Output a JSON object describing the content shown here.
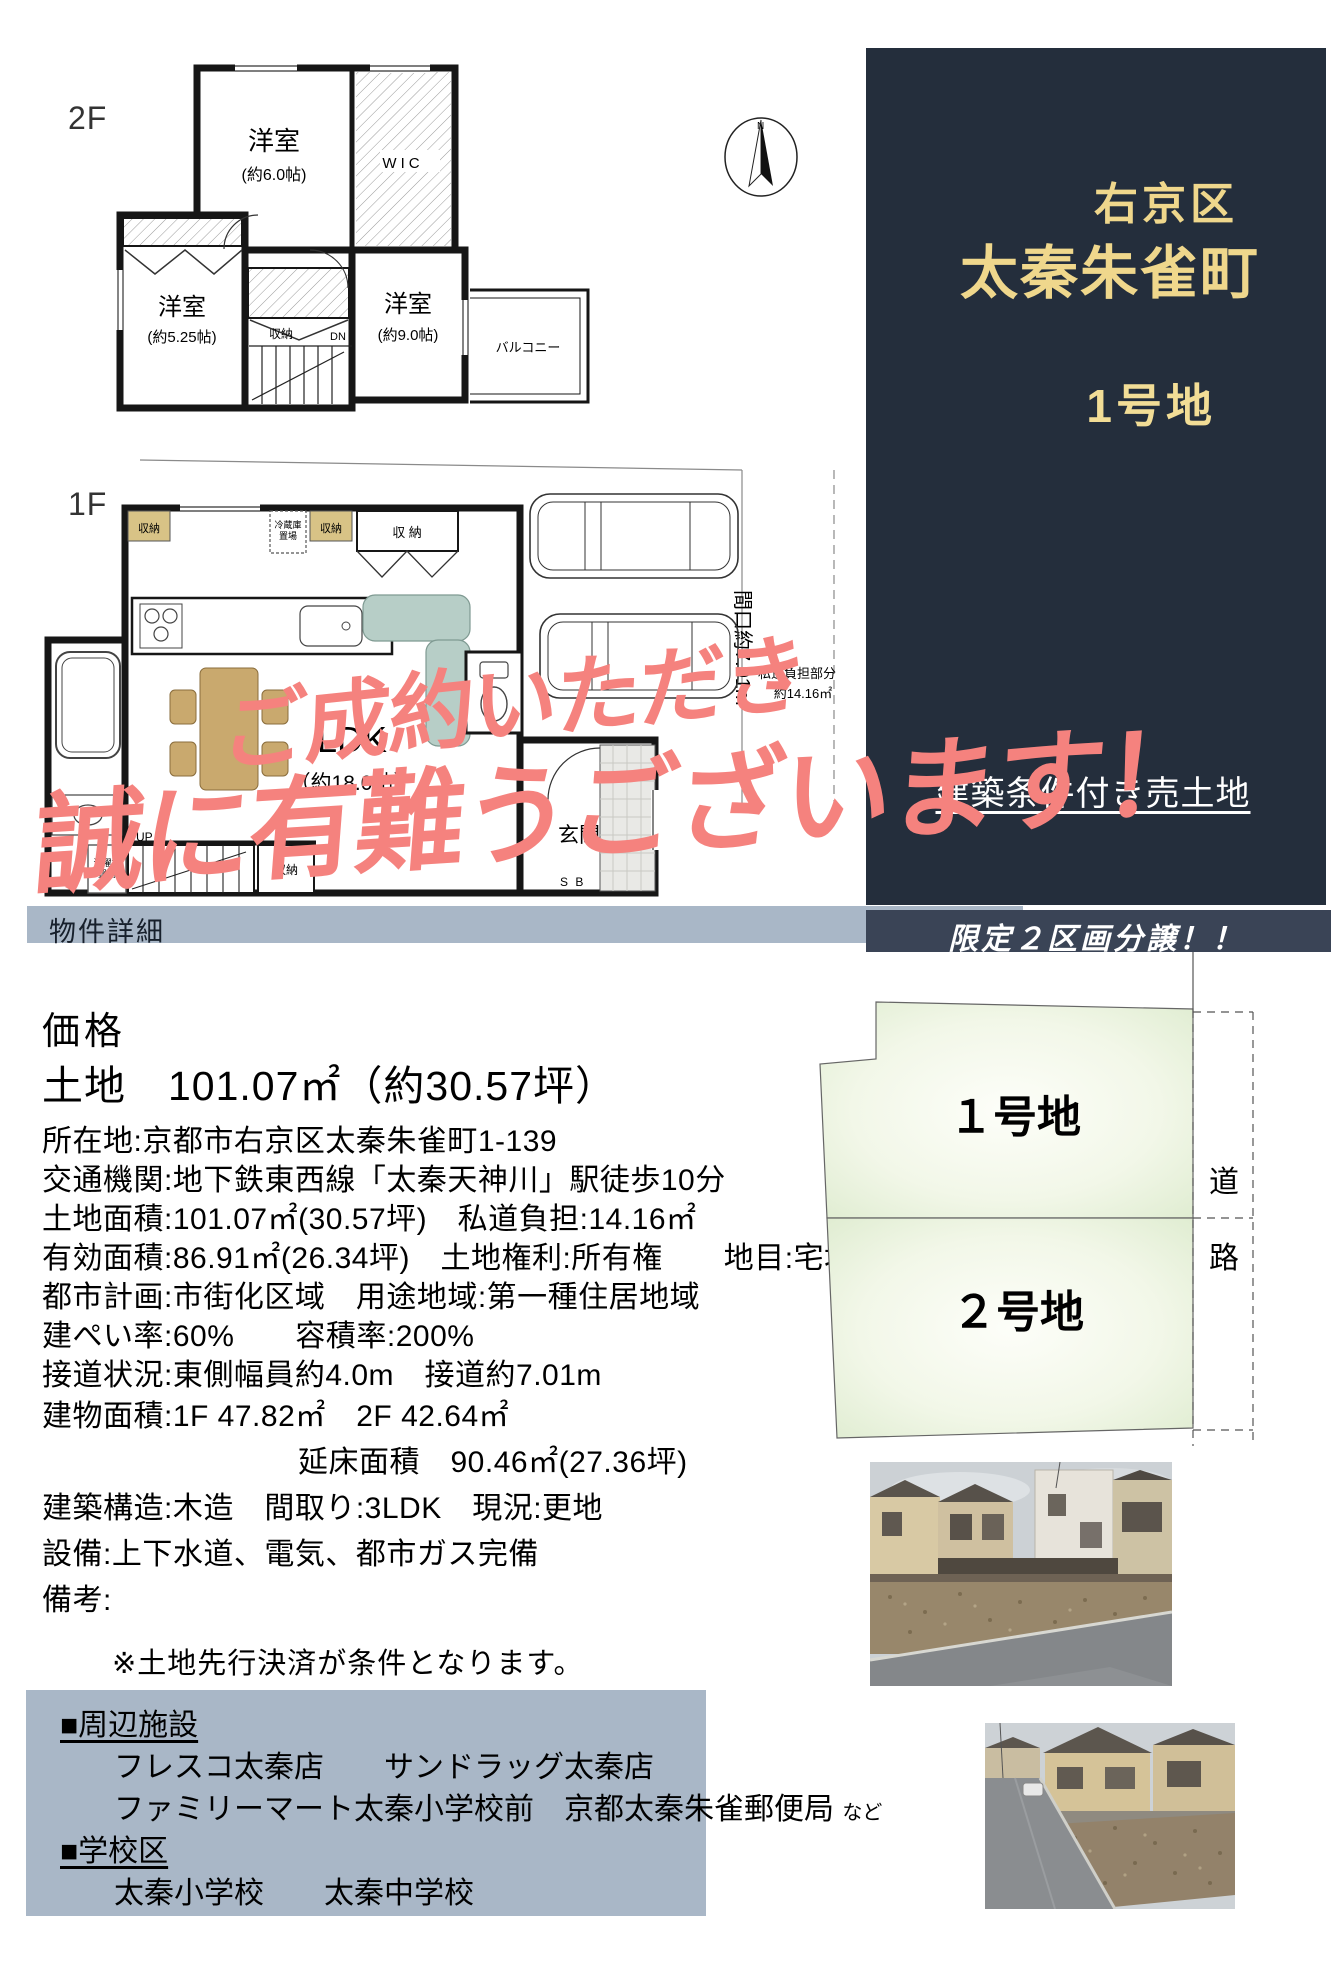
{
  "floorplan_2f": {
    "floor_label": "2F",
    "room_a": "洋室",
    "room_a_size": "(約6.0帖)",
    "wic": "WIC",
    "room_b": "洋室",
    "room_b_size": "(約5.25帖)",
    "room_c": "洋室",
    "room_c_size": "(約9.0帖)",
    "closet": "収納",
    "dn": "DN",
    "balcony": "バルコニー"
  },
  "compass": {
    "north": "N"
  },
  "floorplan_1f": {
    "floor_label": "1F",
    "ldk": "LDK",
    "ldk_size": "（約18.0帖）",
    "genkan": "玄関",
    "shoe_box": "S B",
    "up": "UP",
    "closet_top_left": "収納",
    "closet_top_mid": "収納",
    "closet_top_right": "収 納",
    "closet_stairs": "収納",
    "fridge_line1": "冷蔵庫",
    "fridge_line2": "置場",
    "washer_line1": "洗濯機",
    "washer_line2": "置場",
    "frontage": "間口約7.01m",
    "private_road_line1": "私道負担部分",
    "private_road_line2": "約14.16㎡"
  },
  "sidebar": {
    "district": "右京区",
    "town": "太秦朱雀町",
    "lot_name": "1号地",
    "sale_type": "建築条件付き売土地"
  },
  "banner": {
    "text": "限定２区画分譲！！"
  },
  "overlay": {
    "line1": "ご成約いただき",
    "line2": "誠に有難うございます！"
  },
  "details": {
    "section_title": "物件詳細",
    "price_label": "価格",
    "land_area_line": "土地　101.07㎡（約30.57坪）",
    "rows": [
      "所在地:京都市右京区太秦朱雀町1-139",
      "交通機関:地下鉄東西線「太秦天神川」駅徒歩10分",
      "土地面積:101.07㎡(30.57坪)　私道負担:14.16㎡",
      "有効面積:86.91㎡(26.34坪)　土地権利:所有権　　地目:宅地",
      "都市計画:市街化区域　用途地域:第一種住居地域",
      "建ぺい率:60%　　容積率:200%",
      "接道状況:東側幅員約4.0m　接道約7.01m",
      "建物面積:1F 47.82㎡　2F 42.64㎡",
      "延床面積　90.46㎡(27.36坪)",
      "建築構造:木造　間取り:3LDK　現況:更地",
      "設備:上下水道、電気、都市ガス完備",
      "備考:"
    ],
    "note": "※土地先行決済が条件となります。"
  },
  "lot_plan": {
    "lot1": "１号地",
    "lot2": "２号地",
    "road_char1": "道",
    "road_char2": "路"
  },
  "facilities": {
    "title": "■周辺施設",
    "line1": "フレスコ太秦店　　サンドラッグ太秦店",
    "line2": "ファミリーマート太秦小学校前　京都太秦朱雀郵便局",
    "line2_suffix": "など",
    "school_title": "■学校区",
    "school_line": "太秦小学校　　太秦中学校"
  },
  "colors": {
    "sidebar_bg": "#242e3c",
    "accent_gold": "#efd78c",
    "bar_bg": "#a9b7c7",
    "banner_bg": "#3a4456",
    "overlay_red": "#f5827e",
    "lot_green": "#e4efd6"
  }
}
